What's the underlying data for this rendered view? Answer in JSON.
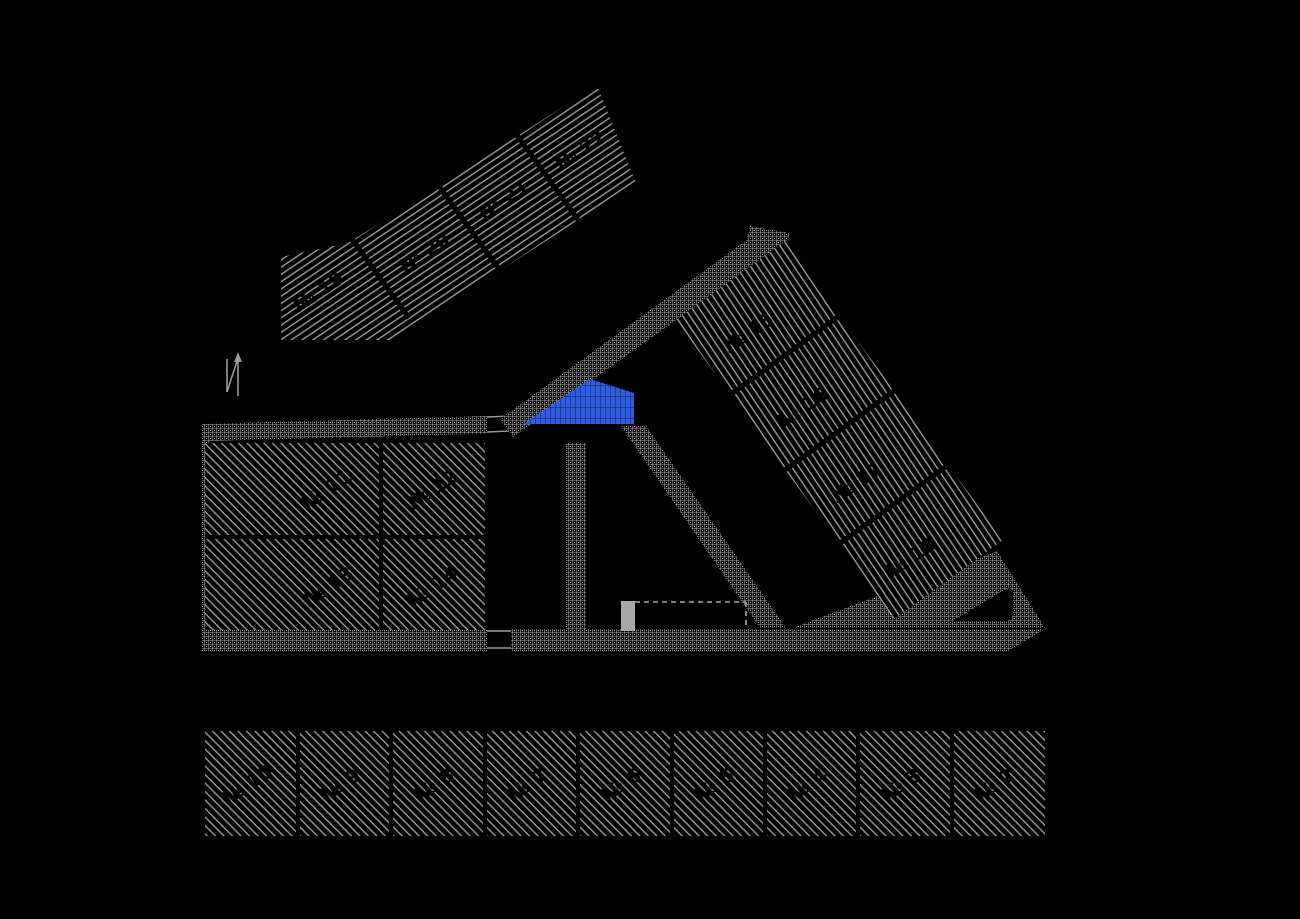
{
  "drawing": {
    "title": "cadastral-site-plan",
    "colors": {
      "background": "#000000",
      "parcel_hatch": "#9a9a9a",
      "road_hatch": "#aeaeae",
      "divider": "#000000",
      "label": "#000000",
      "island_blue": "#2f5fe0"
    },
    "parcel_groups": {
      "top_band": {
        "labels": [
          "№ 19",
          "№ 20",
          "№ 21",
          "№ 22"
        ]
      },
      "right_band": {
        "labels": [
          "№ 15",
          "№ 16",
          "№ 17",
          "№ 18"
        ]
      },
      "west_block": {
        "labels": [
          "№ 11",
          "№ 12",
          "№ 13",
          "№ 14"
        ]
      },
      "south_row": {
        "labels": [
          "№ 10",
          "№ 9",
          "№ 8",
          "№ 7",
          "№ 6",
          "№ 5",
          "№ 4",
          "№ 3",
          "№ 2"
        ]
      }
    },
    "symbols": {
      "north_arrow": "north-arrow",
      "blue_island": "traffic-island",
      "building": "building-footprint"
    }
  }
}
